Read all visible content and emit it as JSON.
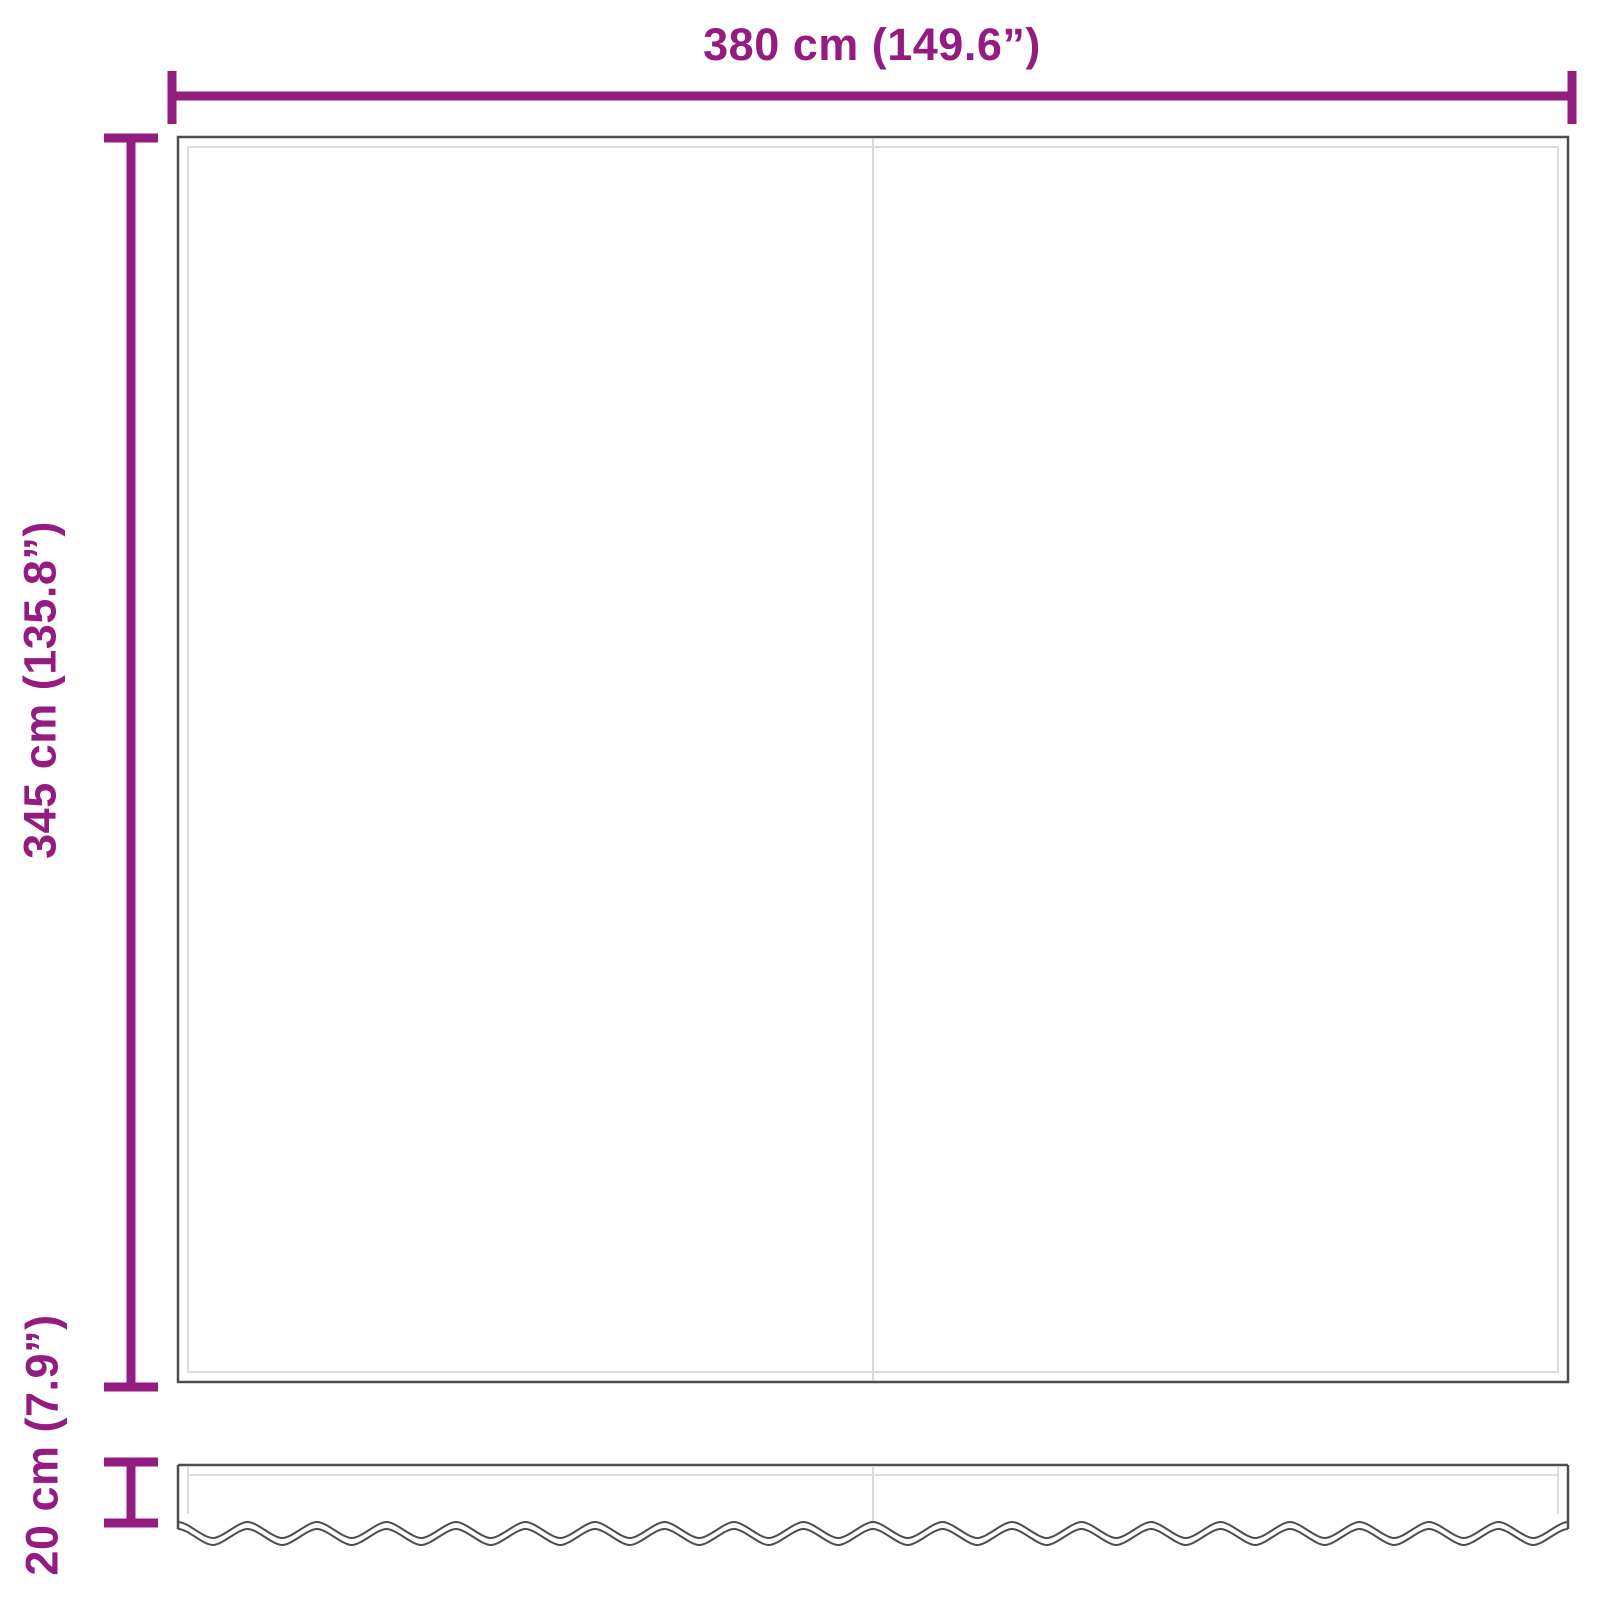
{
  "diagram": {
    "width_label": "380 cm (149.6”)",
    "height_label": "345 cm (135.8”)",
    "valance_label": "20 cm (7.9”)"
  },
  "colors": {
    "accent": "#941b80",
    "outline": "#4d4d4d",
    "inner_line": "#d9d9d9",
    "background": "#ffffff"
  }
}
